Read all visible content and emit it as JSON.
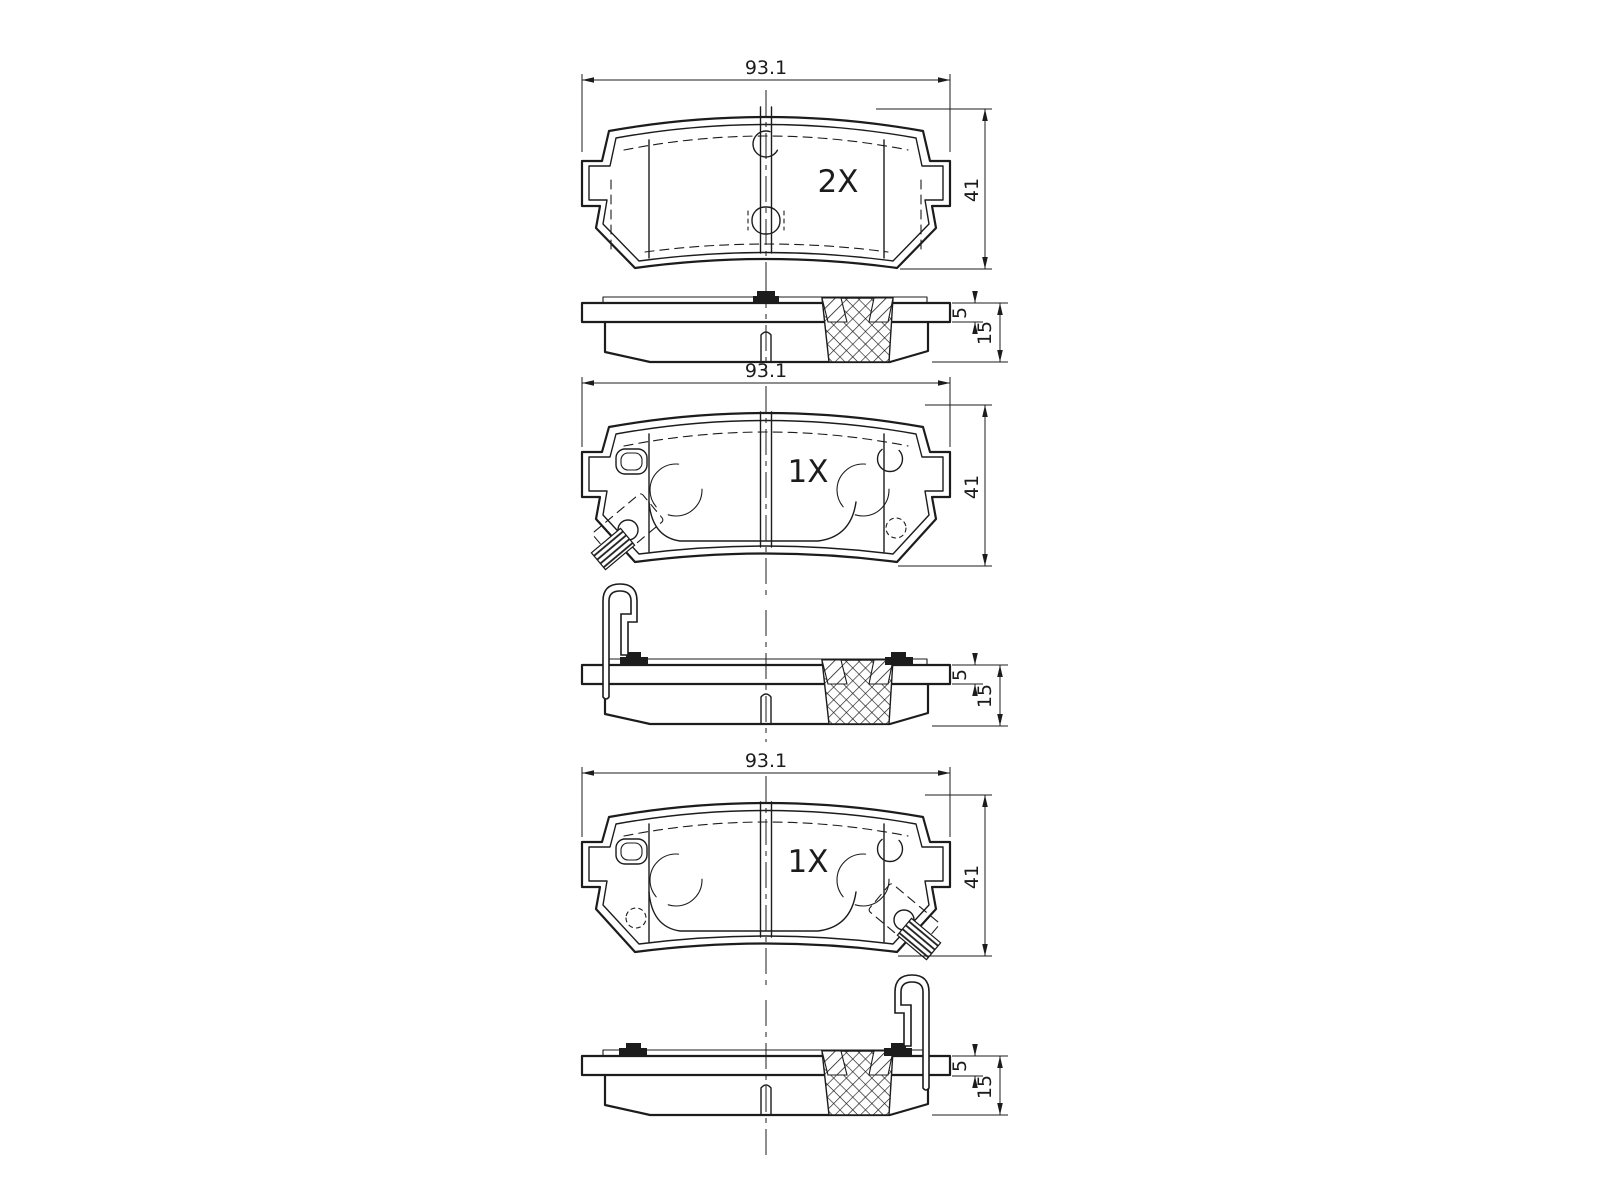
{
  "drawing": {
    "background_color": "#ffffff",
    "line_color": "#1c1c1c",
    "figures": [
      {
        "view": "brake-pad-backplate-view",
        "quantity_label": "2X",
        "width_dim": "93.1",
        "height_dim": "41",
        "plate_thickness_dim": "5",
        "total_thickness_dim": "15"
      },
      {
        "view": "brake-pad-friction-view-indicator-left",
        "quantity_label": "1X",
        "width_dim": "93.1",
        "height_dim": "41",
        "plate_thickness_dim": "5",
        "total_thickness_dim": "15"
      },
      {
        "view": "brake-pad-friction-view-indicator-right",
        "quantity_label": "1X",
        "width_dim": "93.1",
        "height_dim": "41",
        "plate_thickness_dim": "5",
        "total_thickness_dim": "15"
      }
    ]
  }
}
